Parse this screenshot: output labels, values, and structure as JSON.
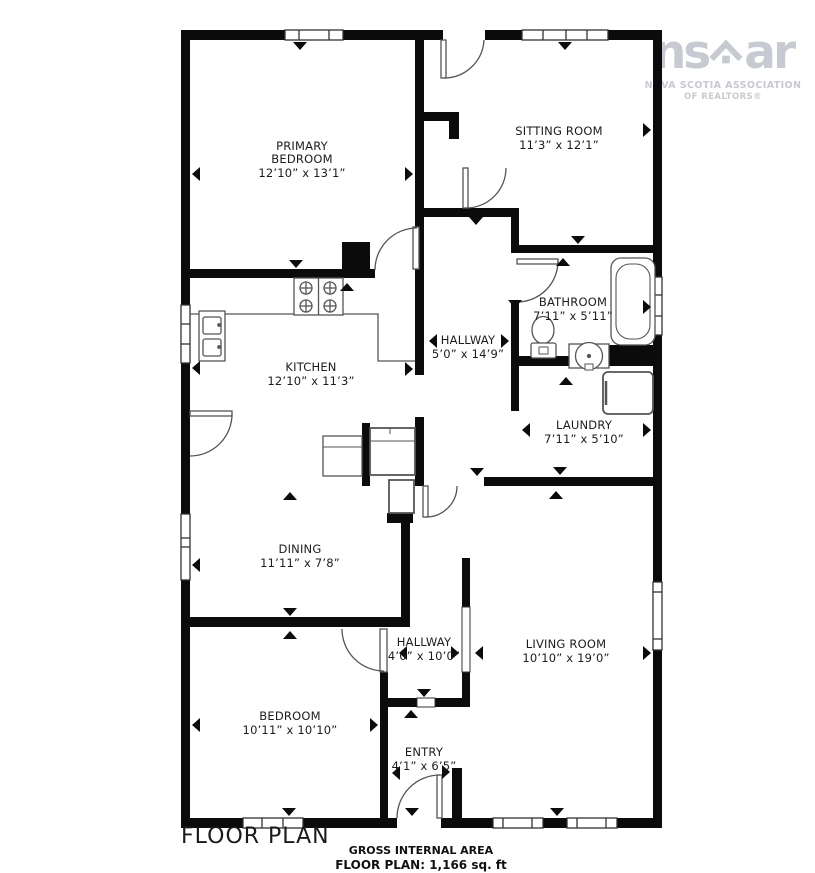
{
  "logo": {
    "brand_prefix": "ns",
    "brand_suffix": "ar",
    "org_line1": "NOVA SCOTIA ASSOCIATION",
    "org_line2": "OF REALTORS®"
  },
  "plan_title": "FLOOR PLAN",
  "footer": {
    "area_label": "GROSS INTERNAL AREA",
    "area_value": "FLOOR PLAN: 1,166 sq. ft",
    "disclaimer": "SIZES AND DIMENSIONS ARE APPROXIMATE, ACTUAL MAY VARY"
  },
  "rooms": [
    {
      "line1": "PRIMARY",
      "line2": "BEDROOM",
      "dims": "12’10” x 13’1”"
    },
    {
      "name": "SITTING ROOM",
      "dims": "11’3” x 12’1”"
    },
    {
      "name": "BATHROOM",
      "dims": "7’11” x 5’11”"
    },
    {
      "name": "HALLWAY",
      "dims": "5’0” x 14’9”"
    },
    {
      "name": "KITCHEN",
      "dims": "12’10” x 11’3”"
    },
    {
      "name": "LAUNDRY",
      "dims": "7’11” x 5’10”"
    },
    {
      "name": "DINING",
      "dims": "11’11” x 7’8”"
    },
    {
      "name": "HALLWAY",
      "dims": "4’0” x 10’0”"
    },
    {
      "name": "LIVING ROOM",
      "dims": "10’10” x 19’0”"
    },
    {
      "name": "BEDROOM",
      "dims": "10’11” x 10’10”"
    },
    {
      "name": "ENTRY",
      "dims": "4’1” x 6’5”"
    }
  ]
}
